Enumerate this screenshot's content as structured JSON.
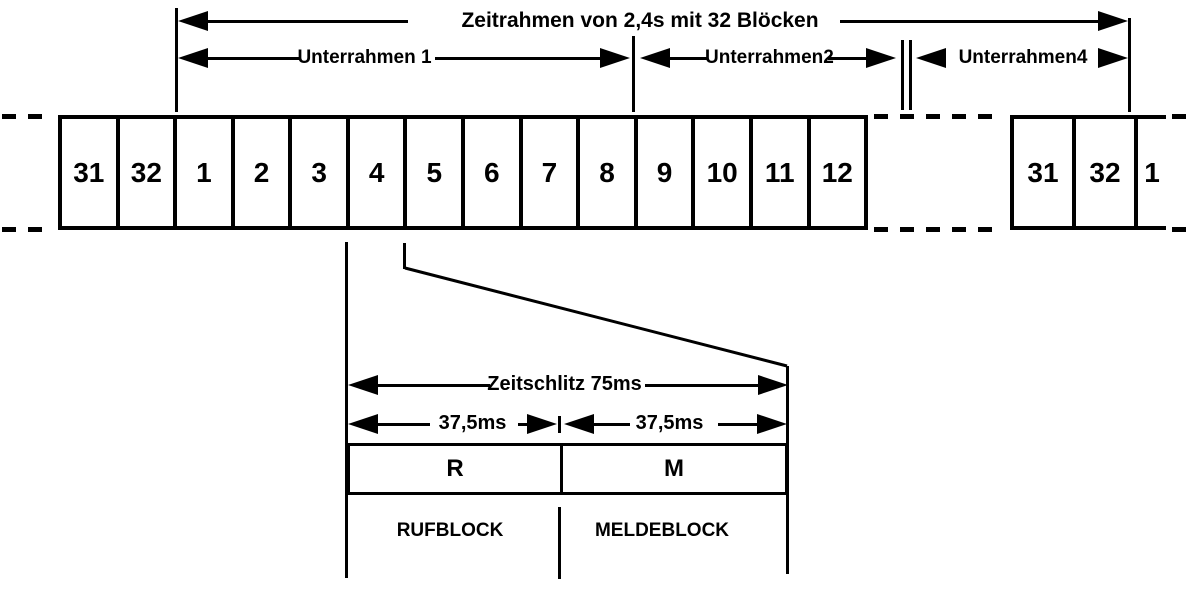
{
  "frame": {
    "title": "Zeitrahmen von 2,4s mit 32 Blöcken",
    "subframe1": "Unterrahmen 1",
    "subframe2": "Unterrahmen2",
    "subframe4": "Unterrahmen4"
  },
  "blocks": {
    "left": [
      "31",
      "32",
      "1",
      "2",
      "3",
      "4",
      "5",
      "6",
      "7",
      "8",
      "9",
      "10",
      "11",
      "12"
    ],
    "right": [
      "31",
      "32",
      "1"
    ]
  },
  "slot": {
    "title": "Zeitschlitz 75ms",
    "half1": "37,5ms",
    "half2": "37,5ms",
    "r": "R",
    "m": "M",
    "r_label": "RUFBLOCK",
    "m_label": "MELDEBLOCK"
  },
  "colors": {
    "ink": "#000000",
    "paper": "#ffffff"
  }
}
